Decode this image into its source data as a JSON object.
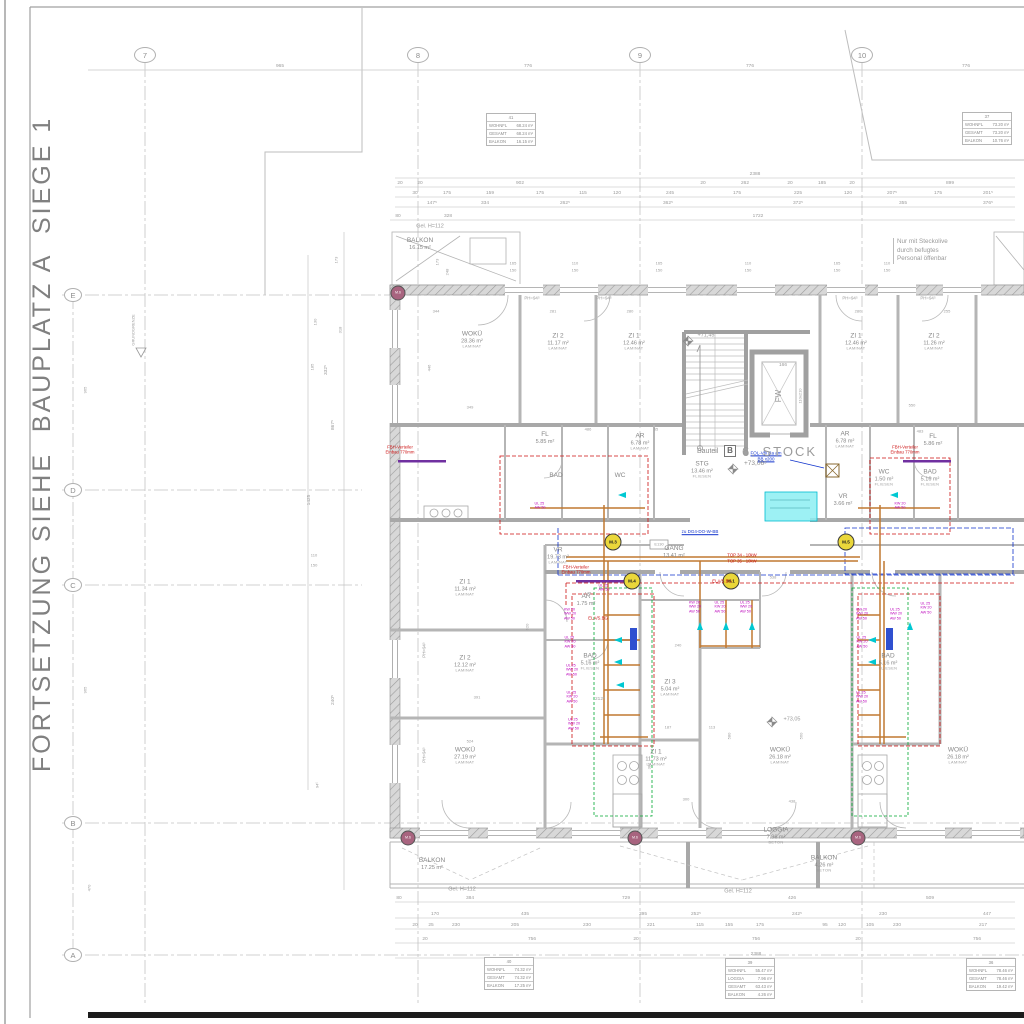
{
  "colors": {
    "line": "#9a9a9a",
    "text": "#878787",
    "dim": "#9b9b9b",
    "wall_fill": "#d6d6d6",
    "red": "#cc1111",
    "magenta": "#bb00bb",
    "violet": "#7030a0",
    "blue": "#1133cc",
    "cyan": "#00bcd0",
    "cyan_fill": "#8ceef2",
    "orange": "#c07830",
    "green": "#00a830",
    "yellow": "#ead73a",
    "pink": "#a8647f"
  },
  "frame": {
    "side_note": "FORTSETZUNG SIEHE  BAUPLATZ A  SIEGE 1"
  },
  "grid": {
    "columns": [
      {
        "label": "7",
        "x": 145
      },
      {
        "label": "8",
        "x": 418
      },
      {
        "label": "9",
        "x": 640
      },
      {
        "label": "10",
        "x": 862
      }
    ],
    "rows": [
      {
        "label": "E",
        "y": 295
      },
      {
        "label": "D",
        "y": 490
      },
      {
        "label": "C",
        "y": 585
      },
      {
        "label": "B",
        "y": 823
      },
      {
        "label": "A",
        "y": 955
      }
    ],
    "column_dims": [
      {
        "t": "965",
        "x": 280
      },
      {
        "t": "776",
        "x": 528
      },
      {
        "t": "776",
        "x": 750
      },
      {
        "t": "776",
        "x": 966
      }
    ]
  },
  "title_block": {
    "bauteil_label": "Bauteil",
    "bauteil_letter": "B",
    "storey": "6. STOCK",
    "level": "+73,06⁵"
  },
  "levels": [
    {
      "t": "+71,45",
      "x": 706,
      "y": 336
    },
    {
      "t": "+73,05",
      "x": 792,
      "y": 720
    }
  ],
  "lift": {
    "label": "FW",
    "num": "166",
    "size": "110x210"
  },
  "notes": {
    "boundary": "GRUNDGRENZE",
    "site_note": "Nur mit Steckolive\ndurch befugtes\nPersonal öffenbar",
    "gel": [
      {
        "x": 430,
        "y": 227
      },
      {
        "x": 462,
        "y": 890
      },
      {
        "x": 738,
        "y": 892
      }
    ],
    "gel_text": "Gel. H=112",
    "e130": "E130"
  },
  "rooms": [
    {
      "n": "BALKON",
      "a": "16.15 m²",
      "f": "",
      "x": 420,
      "y": 244
    },
    {
      "n": "WOKÜ",
      "a": "28.36 m²",
      "f": "LAMINAT",
      "x": 472,
      "y": 340
    },
    {
      "n": "ZI 2",
      "a": "11.17 m²",
      "f": "LAMINAT",
      "x": 558,
      "y": 342
    },
    {
      "n": "ZI 1",
      "a": "12.46 m²",
      "f": "LAMINAT",
      "x": 634,
      "y": 342
    },
    {
      "n": "ZI 1",
      "a": "12.46 m²",
      "f": "LAMINAT",
      "x": 856,
      "y": 342
    },
    {
      "n": "ZI 2",
      "a": "11.26 m²",
      "f": "LAMINAT",
      "x": 934,
      "y": 342
    },
    {
      "n": "FL",
      "a": "5.85 m²",
      "f": "",
      "x": 545,
      "y": 438
    },
    {
      "n": "AR",
      "a": "6.78 m²",
      "f": "LAMINAT",
      "x": 640,
      "y": 442
    },
    {
      "n": "AR",
      "a": "6.78 m²",
      "f": "LAMINAT",
      "x": 845,
      "y": 440
    },
    {
      "n": "FL",
      "a": "5.86 m²",
      "f": "",
      "x": 933,
      "y": 440
    },
    {
      "n": "BAD",
      "a": "",
      "f": "",
      "x": 556,
      "y": 476
    },
    {
      "n": "WC",
      "a": "",
      "f": "",
      "x": 620,
      "y": 476
    },
    {
      "n": "WC",
      "a": "1.50 m²",
      "f": "FLIESEN",
      "x": 884,
      "y": 478
    },
    {
      "n": "BAD",
      "a": "5.16 m²",
      "f": "FLIESEN",
      "x": 930,
      "y": 478
    },
    {
      "n": "VR",
      "a": "3.66 m²",
      "f": "",
      "x": 843,
      "y": 500
    },
    {
      "n": "STG",
      "a": "13.46 m²",
      "f": "FLIESEN",
      "x": 702,
      "y": 470
    },
    {
      "n": "GANG",
      "a": "13.41 m²",
      "f": "",
      "x": 674,
      "y": 552
    },
    {
      "n": "VR",
      "a": "19.73 m²",
      "f": "LAMINAT",
      "x": 558,
      "y": 556
    },
    {
      "n": "AR",
      "a": "1.75 m²",
      "f": "",
      "x": 586,
      "y": 600
    },
    {
      "n": "BAD",
      "a": "5.16 m²",
      "f": "FLIESEN",
      "x": 590,
      "y": 662
    },
    {
      "n": "ZI 3",
      "a": "5.04 m²",
      "f": "LAMINAT",
      "x": 670,
      "y": 688
    },
    {
      "n": "ZI 1",
      "a": "11.34 m²",
      "f": "LAMINAT",
      "x": 465,
      "y": 588
    },
    {
      "n": "ZI 2",
      "a": "12.12 m²",
      "f": "LAMINAT",
      "x": 465,
      "y": 664
    },
    {
      "n": "WOKÜ",
      "a": "27.19 m²",
      "f": "LAMINAT",
      "x": 465,
      "y": 756
    },
    {
      "n": "ZI 1",
      "a": "11.73 m²",
      "f": "LAMINAT",
      "x": 656,
      "y": 758
    },
    {
      "n": "WOKÜ",
      "a": "26.18 m²",
      "f": "LAMINAT",
      "x": 780,
      "y": 756
    },
    {
      "n": "WOKÜ",
      "a": "26.18 m²",
      "f": "LAMINAT",
      "x": 958,
      "y": 756
    },
    {
      "n": "BAD",
      "a": "5.16 m²",
      "f": "FLIESEN",
      "x": 888,
      "y": 662
    },
    {
      "n": "LOGGIA",
      "a": "7.96 m²",
      "f": "BETON",
      "x": 776,
      "y": 836
    },
    {
      "n": "BALKON",
      "a": "4.26 m²",
      "f": "BETON",
      "x": 824,
      "y": 864
    },
    {
      "n": "BALKON",
      "a": "17.25 m²",
      "f": "",
      "x": 432,
      "y": 864
    }
  ],
  "ph_labels": [
    {
      "t": "PH=94⁵",
      "x": 532,
      "y": 298,
      "r": 0
    },
    {
      "t": "PH=94⁵",
      "x": 604,
      "y": 298,
      "r": 0
    },
    {
      "t": "PH=94⁵",
      "x": 850,
      "y": 298,
      "r": 0
    },
    {
      "t": "PH=94⁵",
      "x": 928,
      "y": 298,
      "r": 0
    },
    {
      "t": "PH=94⁵",
      "x": 424,
      "y": 650,
      "r": 1
    },
    {
      "t": "PH=94⁵",
      "x": 424,
      "y": 755,
      "r": 1
    }
  ],
  "area_tables": [
    {
      "no": "41",
      "x": 511,
      "y": 113,
      "rows": [
        [
          "WOHNFL",
          "68.24 m²"
        ],
        [
          "GESAMT",
          "68.24 m²"
        ],
        [
          "BALKON",
          "16.15 m²"
        ]
      ]
    },
    {
      "no": "37",
      "x": 987,
      "y": 112,
      "rows": [
        [
          "WOHNFL",
          "73.20 m²"
        ],
        [
          "GESAMT",
          "73.20 m²"
        ],
        [
          "BALKON",
          "10.76 m²"
        ]
      ]
    },
    {
      "no": "40",
      "x": 509,
      "y": 957,
      "rows": [
        [
          "WOHNFL",
          "74.32 m²"
        ],
        [
          "GESAMT",
          "74.32 m²"
        ],
        [
          "BALKON",
          "17.25 m²"
        ]
      ]
    },
    {
      "no": "39",
      "x": 750,
      "y": 958,
      "rows": [
        [
          "WOHNFL",
          "55.47 m²"
        ],
        [
          "LOGGIA",
          "7.96 m²"
        ],
        [
          "GESAMT",
          "63.43 m²"
        ],
        [
          "BALKON",
          "4.26 m²"
        ]
      ]
    },
    {
      "no": "36",
      "x": 991,
      "y": 958,
      "rows": [
        [
          "WOHNFL",
          "78.46 m²"
        ],
        [
          "GESAMT",
          "78.46 m²"
        ],
        [
          "BALKON",
          "19.42 m²"
        ]
      ]
    }
  ],
  "markers": {
    "yellow": [
      {
        "label": "M.3",
        "x": 613,
        "y": 542
      },
      {
        "label": "M.4",
        "x": 632,
        "y": 581
      },
      {
        "label": "M.1",
        "x": 731,
        "y": 581
      },
      {
        "label": "M.5",
        "x": 846,
        "y": 542
      }
    ],
    "pink": [
      {
        "label": "M.6",
        "x": 398,
        "y": 293
      },
      {
        "label": "M.6",
        "x": 408,
        "y": 838
      },
      {
        "label": "M.6",
        "x": 635,
        "y": 838
      },
      {
        "label": "M.6",
        "x": 858,
        "y": 838
      }
    ]
  },
  "annotations": {
    "red": [
      {
        "lines": "FBH-Verteiler\nEinbau 770mm",
        "x": 400,
        "y": 450
      },
      {
        "lines": "FBH-Verteiler\nEinbau 770mm",
        "x": 576,
        "y": 570
      },
      {
        "lines": "FBH-Verteiler\nEinbau 770mm",
        "x": 905,
        "y": 450
      },
      {
        "lines": "TOP 34 - 10kW",
        "x": 742,
        "y": 555
      },
      {
        "lines": "TOP 35 - 10kW",
        "x": 742,
        "y": 561
      },
      {
        "lines": "ELA/S.BG",
        "x": 722,
        "y": 581
      },
      {
        "lines": "ELA/S.BG",
        "x": 598,
        "y": 618
      }
    ],
    "blue": [
      {
        "lines": "zu DG4-DO-W-BB",
        "x": 700,
        "y": 532
      },
      {
        "lines": "FOL-Vfli Ra am\nBB x200",
        "x": 766,
        "y": 456
      }
    ],
    "magenta": [
      {
        "lines": "KW 20\nWW 20\nAW 50",
        "x": 570,
        "y": 614
      },
      {
        "lines": "UL 25\nKW 20\nAW 50",
        "x": 570,
        "y": 642
      },
      {
        "lines": "UL 25\nWW 20\nAW 50",
        "x": 572,
        "y": 670
      },
      {
        "lines": "UL 25\nKW 20\nAW 50",
        "x": 572,
        "y": 697
      },
      {
        "lines": "UL 25\nWW 20\nAW 50",
        "x": 574,
        "y": 724
      },
      {
        "lines": "KW 20\nWW 20\nAW 50",
        "x": 695,
        "y": 607
      },
      {
        "lines": "UL 25\nKW 20\nAW 50",
        "x": 720,
        "y": 607
      },
      {
        "lines": "UL 25\nWW 20\nAW 50",
        "x": 746,
        "y": 607
      },
      {
        "lines": "KW 20\nWW 20\nAW 50",
        "x": 862,
        "y": 614
      },
      {
        "lines": "UL 25\nKW 20\nAW 50",
        "x": 862,
        "y": 642
      },
      {
        "lines": "UL 25\nWW 20\nAW 50",
        "x": 896,
        "y": 614
      },
      {
        "lines": "UL 25\nKW 20\nAW 50",
        "x": 926,
        "y": 608
      },
      {
        "lines": "UL 25\nWW 20\nAW 50",
        "x": 862,
        "y": 697
      },
      {
        "lines": "UL 25\nAW 50",
        "x": 540,
        "y": 506
      },
      {
        "lines": "KW 20\nAW 50",
        "x": 900,
        "y": 506
      },
      {
        "lines": "UL 25\nAW 50",
        "x": 604,
        "y": 588
      }
    ]
  },
  "dims": {
    "top_rows": [
      {
        "y": 175,
        "items": [
          {
            "t": "2388",
            "x": 755
          }
        ]
      },
      {
        "y": 184,
        "items": [
          {
            "t": "20",
            "x": 400
          },
          {
            "t": "20",
            "x": 420
          },
          {
            "t": "902",
            "x": 520
          },
          {
            "t": "20",
            "x": 703
          },
          {
            "t": "262",
            "x": 745
          },
          {
            "t": "20",
            "x": 790
          },
          {
            "t": "185",
            "x": 822
          },
          {
            "t": "20",
            "x": 852
          },
          {
            "t": "899",
            "x": 950
          }
        ]
      },
      {
        "y": 194,
        "items": [
          {
            "t": "30",
            "x": 415
          },
          {
            "t": "175",
            "x": 447
          },
          {
            "t": "159",
            "x": 490
          },
          {
            "t": "175",
            "x": 540
          },
          {
            "t": "115",
            "x": 583
          },
          {
            "t": "120",
            "x": 617
          },
          {
            "t": "245",
            "x": 670
          },
          {
            "t": "175",
            "x": 737
          },
          {
            "t": "225",
            "x": 798
          },
          {
            "t": "120",
            "x": 848
          },
          {
            "t": "207⁵",
            "x": 892
          },
          {
            "t": "175",
            "x": 938
          },
          {
            "t": "201⁵",
            "x": 988
          }
        ]
      },
      {
        "y": 204,
        "items": [
          {
            "t": "147⁵",
            "x": 432
          },
          {
            "t": "334",
            "x": 485
          },
          {
            "t": "262⁵",
            "x": 565
          },
          {
            "t": "362⁵",
            "x": 668
          },
          {
            "t": "372⁵",
            "x": 798
          },
          {
            "t": "355",
            "x": 903
          },
          {
            "t": "376⁵",
            "x": 988
          }
        ]
      },
      {
        "y": 217,
        "items": [
          {
            "t": "80",
            "x": 398
          },
          {
            "t": "328",
            "x": 448
          },
          {
            "t": "1722",
            "x": 758
          }
        ]
      }
    ],
    "bottom_rows": [
      {
        "y": 899,
        "items": [
          {
            "t": "80",
            "x": 399
          },
          {
            "t": "384",
            "x": 470
          },
          {
            "t": "729",
            "x": 626
          },
          {
            "t": "426",
            "x": 792
          },
          {
            "t": "509",
            "x": 930
          }
        ]
      },
      {
        "y": 915,
        "items": [
          {
            "t": "170",
            "x": 435
          },
          {
            "t": "435",
            "x": 525
          },
          {
            "t": "395",
            "x": 643
          },
          {
            "t": "252⁵",
            "x": 696
          },
          {
            "t": "242⁵",
            "x": 797
          },
          {
            "t": "230",
            "x": 883
          },
          {
            "t": "447",
            "x": 987
          }
        ]
      },
      {
        "y": 926,
        "items": [
          {
            "t": "20",
            "x": 415
          },
          {
            "t": "25",
            "x": 431
          },
          {
            "t": "230",
            "x": 456
          },
          {
            "t": "205",
            "x": 515
          },
          {
            "t": "230",
            "x": 587
          },
          {
            "t": "221",
            "x": 651
          },
          {
            "t": "115",
            "x": 700
          },
          {
            "t": "155",
            "x": 729
          },
          {
            "t": "175",
            "x": 760
          },
          {
            "t": "95",
            "x": 825
          },
          {
            "t": "120",
            "x": 842
          },
          {
            "t": "105",
            "x": 870
          },
          {
            "t": "230",
            "x": 897
          },
          {
            "t": "217",
            "x": 983
          }
        ]
      },
      {
        "y": 940,
        "items": [
          {
            "t": "20",
            "x": 425
          },
          {
            "t": "756",
            "x": 532
          },
          {
            "t": "20",
            "x": 636
          },
          {
            "t": "756",
            "x": 756
          },
          {
            "t": "20",
            "x": 858
          },
          {
            "t": "756",
            "x": 977
          }
        ]
      },
      {
        "y": 955,
        "items": [
          {
            "t": "2388",
            "x": 756
          }
        ]
      }
    ],
    "misc": [
      {
        "t": "344",
        "x": 436,
        "y": 312
      },
      {
        "t": "281",
        "x": 553,
        "y": 312
      },
      {
        "t": "280",
        "x": 630,
        "y": 312
      },
      {
        "t": "280",
        "x": 858,
        "y": 312
      },
      {
        "t": "255",
        "x": 947,
        "y": 312
      },
      {
        "t": "446",
        "x": 430,
        "y": 368,
        "r": 1
      },
      {
        "t": "349",
        "x": 470,
        "y": 408
      },
      {
        "t": "486",
        "x": 588,
        "y": 430
      },
      {
        "t": "65",
        "x": 656,
        "y": 430
      },
      {
        "t": "550",
        "x": 912,
        "y": 406
      },
      {
        "t": "483",
        "x": 920,
        "y": 432
      },
      {
        "t": "240",
        "x": 678,
        "y": 646
      },
      {
        "t": "212⁵",
        "x": 600,
        "y": 700
      },
      {
        "t": "391",
        "x": 477,
        "y": 698
      },
      {
        "t": "524",
        "x": 470,
        "y": 742
      },
      {
        "t": "187",
        "x": 668,
        "y": 728
      },
      {
        "t": "113",
        "x": 712,
        "y": 728
      },
      {
        "t": "300",
        "x": 686,
        "y": 800
      },
      {
        "t": "438",
        "x": 792,
        "y": 802
      },
      {
        "t": "580",
        "x": 730,
        "y": 736,
        "r": 1
      },
      {
        "t": "560",
        "x": 802,
        "y": 736,
        "r": 1
      },
      {
        "t": "382",
        "x": 650,
        "y": 766,
        "r": 1
      },
      {
        "t": "620",
        "x": 528,
        "y": 627,
        "r": 1
      },
      {
        "t": "173",
        "x": 337,
        "y": 260,
        "r": 1
      },
      {
        "t": "130",
        "x": 316,
        "y": 322,
        "r": 1
      },
      {
        "t": "318",
        "x": 341,
        "y": 330,
        "r": 1
      },
      {
        "t": "185",
        "x": 313,
        "y": 367,
        "r": 1
      },
      {
        "t": "332⁵",
        "x": 327,
        "y": 370,
        "r": 1
      },
      {
        "t": "867⁵",
        "x": 334,
        "y": 425,
        "r": 1
      },
      {
        "t": "1425",
        "x": 310,
        "y": 500,
        "r": 1
      },
      {
        "t": "110",
        "x": 314,
        "y": 556
      },
      {
        "t": "150",
        "x": 314,
        "y": 566
      },
      {
        "t": "240⁵",
        "x": 334,
        "y": 700,
        "r": 1
      },
      {
        "t": "94⁵",
        "x": 318,
        "y": 785,
        "r": 1
      },
      {
        "t": "965",
        "x": 86,
        "y": 390,
        "r": 1
      },
      {
        "t": "965",
        "x": 86,
        "y": 690,
        "r": 1
      },
      {
        "t": "470",
        "x": 90,
        "y": 888,
        "r": 1
      },
      {
        "t": "173",
        "x": 438,
        "y": 262,
        "r": 1
      },
      {
        "t": "248",
        "x": 448,
        "y": 272,
        "r": 1
      },
      {
        "t": "165",
        "x": 513,
        "y": 264
      },
      {
        "t": "150",
        "x": 513,
        "y": 271
      },
      {
        "t": "110",
        "x": 575,
        "y": 264
      },
      {
        "t": "150",
        "x": 575,
        "y": 271
      },
      {
        "t": "165",
        "x": 659,
        "y": 264
      },
      {
        "t": "150",
        "x": 659,
        "y": 271
      },
      {
        "t": "110",
        "x": 748,
        "y": 264
      },
      {
        "t": "150",
        "x": 748,
        "y": 271
      },
      {
        "t": "165",
        "x": 837,
        "y": 264
      },
      {
        "t": "150",
        "x": 837,
        "y": 271
      },
      {
        "t": "110",
        "x": 887,
        "y": 264
      },
      {
        "t": "150",
        "x": 887,
        "y": 271
      },
      {
        "t": "538",
        "x": 773,
        "y": 578
      },
      {
        "t": "175",
        "x": 588,
        "y": 594
      }
    ]
  }
}
